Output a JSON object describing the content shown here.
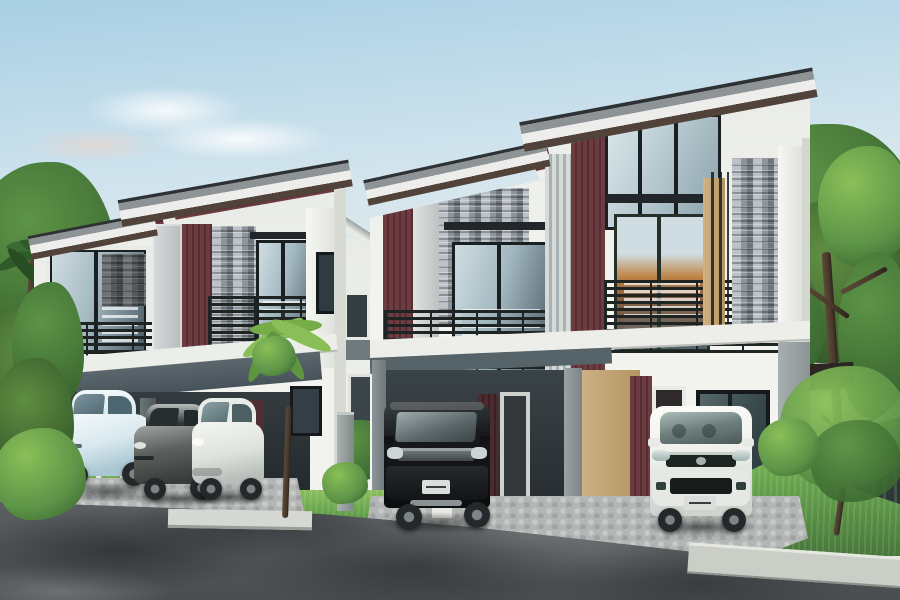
{
  "meta": {
    "type": "architectural-rendering",
    "subject": "Modern two-storey duplex townhouses with balconies, carports, five parked cars and landscaped street",
    "style": "photo-real 3D real-estate render",
    "time_of_day": "late afternoon, warm horizon light at left"
  },
  "palette": {
    "sky_top": "#a8cfe4",
    "sky_mid": "#cfe3ed",
    "sky_warm": "#f5ead9",
    "glow": "#ffe9cf",
    "roof_dark": "#2e3234",
    "roof_face": "#8e9396",
    "fascia": "#edeeec",
    "eave_shadow": "#51423a",
    "maroon": "#6e3c40",
    "maroon_dark": "#532e33",
    "stone_light": "#bcc2c7",
    "stone_mid": "#8d949a",
    "stone_dark": "#6f767c",
    "wall_white": "#eff0ec",
    "wall_shade": "#d8dad4",
    "wall_gray": "#9aa2a4",
    "tan_wall": "#c6a97e",
    "frame": "#1a1f21",
    "railing": "#1d2422",
    "glass_hi": "#cfdde2",
    "glass_mid": "#a4b9c1",
    "glass_lo": "#4b5c66",
    "glass_warm": "#c08448",
    "carport": "#4e5a60",
    "carport_interior": "#2c3336",
    "road": "#54585a",
    "road_dark": "#393d3f",
    "road_light": "#83888a",
    "cobble": "#b3b6b4",
    "cobble_light": "#c7cac7",
    "cobble_dark": "#9fa2a0",
    "grass": "#66a24c",
    "grass_light": "#8cc05e",
    "grass_dark": "#47763a",
    "leaf_light": "#8abf58",
    "leaf_mid": "#5d9447",
    "leaf_dark": "#39652f",
    "trunk": "#4a3a2c",
    "fence_dark": "#2c3836",
    "fence_light": "#e7ece8",
    "sidewalk": "#cbcdc7",
    "curb": "#d6d8d4",
    "car_blue": "#d9e9ef",
    "car_graphite": "#5c615e",
    "car_white": "#eff1ed",
    "car_black": "#17191b",
    "suv_white": "#f0f1ed",
    "plate": "#dcdedb"
  },
  "scene": {
    "sky": {
      "description": "clear sky, light blue above fading to warm cream at the left horizon",
      "clouds": 2
    },
    "buildings": [
      {
        "id": "house-left",
        "type": "duplex townhouse",
        "storeys": 2,
        "features": [
          "stepped skillion roof",
          "maroon slat accent panels",
          "stone veneer columns",
          "glass balcony doors",
          "dark metal balcony railings",
          "double carport"
        ],
        "parked_cars": 3
      },
      {
        "id": "house-right",
        "type": "duplex townhouse",
        "storeys": 2,
        "features": [
          "stepped skillion roof",
          "maroon slat accent panels",
          "stone veneer columns",
          "tan porch wall",
          "balcony railings",
          "carport"
        ],
        "parked_cars": 2
      },
      {
        "id": "house-background",
        "type": "townhouse behind gap",
        "features": [
          "white wall",
          "gray band",
          "small windows"
        ]
      }
    ],
    "cars": [
      {
        "id": "car-1",
        "color": "pale blue",
        "body": "compact hatchback"
      },
      {
        "id": "car-2",
        "color": "graphite gray",
        "body": "sedan"
      },
      {
        "id": "car-3",
        "color": "white",
        "body": "compact hatchback"
      },
      {
        "id": "car-4",
        "color": "black",
        "body": "MPV / SUV",
        "license_plate": true
      },
      {
        "id": "car-5",
        "color": "white",
        "body": "SUV front view",
        "license_plate": true
      }
    ],
    "vegetation": [
      "left tree cluster with palm trunk",
      "bright palm shrub mid-frame",
      "small trees in gap between houses",
      "large leafy tree right",
      "small garden tree on right lawn",
      "lawn strips"
    ],
    "ground": [
      "dark asphalt road with dappled tree shadows",
      "cobblestone driveways",
      "concrete curb slab",
      "diagonal sidewalk right",
      "green lawns"
    ],
    "fences": [
      {
        "side": "left",
        "style": "light posts"
      },
      {
        "side": "right",
        "style": "dark slats"
      }
    ],
    "structures": [
      "gray gate pillar between lots",
      "white gate block",
      "dark beam behind right tree"
    ]
  }
}
